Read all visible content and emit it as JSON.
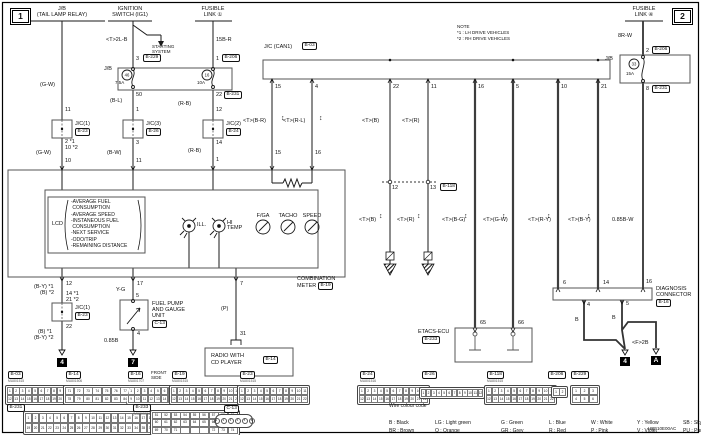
{
  "page": {
    "no_left": "1",
    "no_right": "2",
    "corner_code": "HBF10E00AC"
  },
  "icons": {
    "twist": "↕"
  },
  "note": {
    "title": "NOTE",
    "l1": "*1 : LH DRIVE VEHICLES",
    "l2": "*2 : RH DRIVE VEHICLES"
  },
  "top": {
    "jb1": "J/B",
    "jb2": "(TAIL LAMP RELAY)",
    "ign1": "IGNITION",
    "ign2": "SWITCH (IG1)",
    "fl1a": "FUSIBLE",
    "fl1b": "LINK ①",
    "fl4a": "FUSIBLE",
    "fl4b": "LINK ④",
    "ss1": "STARTING",
    "ss2": "SYSTEM"
  },
  "jb": {
    "left": "J/B",
    "right": "J/B",
    "f46": "46",
    "f46a": "7.5A",
    "f16": "16",
    "f16a": "10A",
    "f33": "33",
    "f33a": "15A"
  },
  "comp": {
    "jc_can": "J/C (CAN1)",
    "jc1": "J/C(1)",
    "jc2": "J/C(2)",
    "jc3": "J/C(3)",
    "jc1l": "J/C(1)",
    "fuel1": "FUEL PUMP",
    "fuel2": "AND GAUGE",
    "fuel3": "UNIT",
    "radio1": "RADIO WITH",
    "radio2": "CD PLAYER",
    "etacs": "ETACS-ECU",
    "diag1": "DIAGNOSIS",
    "diag2": "CONNECTOR"
  },
  "refs": {
    "b229": "B-229",
    "b206a": "B-206",
    "b206b": "B-206",
    "b231a": "B-231",
    "b231b": "B-231",
    "b23a": "B-23",
    "b26": "B-26",
    "b24": "B-24",
    "b03": "B-03",
    "b118": "B-118",
    "b19": "B-19",
    "b23b": "B-23",
    "c13": "C-13",
    "b14": "B-14",
    "b233": "B-233",
    "b16": "B-16"
  },
  "wires": {
    "gw1": "(G-W)",
    "t2lb": "<T>2L-B",
    "f15br": "15B-R",
    "f8rw": "8R-W",
    "bl": "(B-L)",
    "rb1": "(R-B)",
    "rb2": "(R-B)",
    "gw2": "(G-W)",
    "bw": "(B-W)",
    "cbr": "<T>(B-R)",
    "crl": "<T>(R-L)",
    "cb1": "<T>(B)",
    "cr1": "<T>(R)",
    "cb2": "<T>(B)",
    "cr2": "<T>(R)",
    "cbg": "<T>(B-G)",
    "cgw": "<T>(G-W)",
    "cry": "<T>(R-Y)",
    "cby": "<T>(B-Y)",
    "w085bw": "0.85B-W",
    "by1": "(B-Y) *1",
    "b2": "(B) *2",
    "b1": "(B) *1",
    "by2": "(B-Y) *2",
    "yg": "Y-G",
    "w085b": "0.85B",
    "p": "(P)",
    "bd1": "B",
    "bd2": "B",
    "f2b": "<F>2B"
  },
  "pins": {
    "p3": "3",
    "p1a": "1",
    "p50": "50",
    "p22a": "22",
    "p2": "2",
    "p8": "8",
    "p11a": "11",
    "p1b": "1",
    "p12a": "12",
    "p2s": "2 *1",
    "p10s": "10 *2",
    "p3b": "3",
    "p14s": "14 *1",
    "p21s": "21 *2",
    "p14a": "14",
    "p10": "10",
    "p11b": "11",
    "p1c": "1",
    "c15": "15",
    "c4": "4",
    "c22": "22",
    "c11": "11",
    "c16": "16",
    "c5": "5",
    "c10": "10",
    "c21": "21",
    "m15": "15",
    "m16": "16",
    "b118_12": "12",
    "b118_13": "13",
    "m12": "12",
    "m17": "17",
    "m7": "7",
    "p22b": "22",
    "p5": "5",
    "p4": "4",
    "p31": "31",
    "e65": "65",
    "e66": "66",
    "d6": "6",
    "d14": "14",
    "d16": "16",
    "d4": "4",
    "d5": "5"
  },
  "grounds": {
    "g4a": "4",
    "g7": "7",
    "g4b": "4",
    "ga": "A"
  },
  "meter": {
    "lcd": "LCD",
    "lines": [
      "-AVERAGE FUEL",
      " CONSUMPTION",
      "-AVERAGE SPEED",
      "-INSTANEOUS FUEL",
      " CONSUMPTION",
      "-NEXT SERVICE",
      "-ODO/TRIP",
      "-REMAINING DISTANCE"
    ],
    "ill": "ILL.",
    "hi1": "HI",
    "hi2": "TEMP",
    "g1": "F/GA",
    "g2": "TACHO",
    "g3": "SPEED",
    "n1": "COMBINATION",
    "n2": "METER"
  },
  "tables": {
    "b03": {
      "t": "B-03",
      "c": "MU801515",
      "r": [
        [
          1,
          2,
          3,
          4,
          5,
          6,
          7,
          8,
          9,
          10,
          11
        ],
        [
          12,
          13,
          14,
          15,
          16,
          17,
          18,
          19,
          20,
          21,
          22
        ]
      ]
    },
    "b14": {
      "t": "B-14",
      "c": "MU801506",
      "r": [
        [
          71,
          72,
          73,
          74,
          75,
          76,
          77
        ],
        [
          78,
          79,
          80,
          81,
          82,
          83,
          84
        ]
      ]
    },
    "b16": {
      "t": "B-16",
      "c": "MU801707",
      "n1": "FRONT",
      "n2": "SIDE",
      "r": [
        [
          1,
          2,
          3,
          4,
          5,
          6,
          7,
          8
        ],
        [
          9,
          10,
          11,
          12,
          13,
          14,
          15,
          16
        ]
      ]
    },
    "b19": {
      "t": "B-19",
      "c": "MU801515",
      "r": [
        [
          1,
          2,
          3,
          4,
          5,
          6,
          7,
          8,
          9,
          10,
          11
        ],
        [
          12,
          13,
          14,
          15,
          16,
          17,
          18,
          19,
          20,
          21,
          22
        ]
      ]
    },
    "b23": {
      "t": "B-23",
      "c": "MU801515",
      "r": [
        [
          1,
          2,
          3,
          4,
          5,
          6,
          7,
          8,
          9,
          10,
          11
        ],
        [
          12,
          13,
          14,
          15,
          16,
          17,
          18,
          19,
          20,
          21,
          22
        ]
      ]
    },
    "b24": {
      "t": "B-24",
      "c": "MU801516",
      "r": [
        [
          1,
          2,
          3,
          4,
          5,
          6,
          7,
          8,
          9,
          10,
          11
        ],
        [
          12,
          13,
          14,
          15,
          16,
          17,
          18,
          19,
          20,
          21,
          22
        ]
      ]
    },
    "b26": {
      "t": "B-26",
      "r": [
        [
          1,
          2,
          3,
          4,
          5,
          6,
          7,
          8,
          9,
          10,
          11,
          12
        ]
      ]
    },
    "b118": {
      "t": "B-118",
      "c": "MU801515",
      "r": [
        [
          1,
          2,
          3,
          4,
          5,
          6,
          7,
          8,
          9,
          10,
          11
        ],
        [
          12,
          13,
          14,
          15,
          16,
          17,
          18,
          19,
          20,
          21,
          22
        ]
      ]
    },
    "b206": {
      "t": "B-206",
      "r": [
        [
          1,
          2
        ]
      ]
    },
    "b229": {
      "t": "B-229",
      "r": [
        [
          1,
          2,
          3
        ],
        [
          4,
          5,
          6
        ]
      ]
    },
    "b231": {
      "t": "B-231",
      "r": [
        [
          1,
          2,
          3,
          4,
          5,
          6,
          7,
          8,
          9,
          10,
          11,
          12,
          13,
          14,
          15,
          16,
          17,
          18
        ],
        [
          19,
          20,
          21,
          22,
          23,
          24,
          25,
          26,
          27,
          28,
          29,
          30,
          31,
          32,
          33,
          34,
          35,
          36
        ]
      ]
    },
    "b233": {
      "t": "B-233",
      "c": "(MU803746)",
      "r": [
        [
          51,
          52,
          53,
          54,
          55,
          56,
          57,
          58,
          59
        ],
        [
          60,
          61,
          62,
          63,
          64,
          65,
          66,
          67,
          68
        ],
        [
          "69",
          "70",
          "71",
          "",
          "",
          "",
          "72",
          "73",
          "74"
        ]
      ]
    },
    "c13": {
      "t": "C-13",
      "pins": [
        "1",
        "2",
        "3",
        "4",
        "5",
        "6"
      ]
    }
  },
  "legend": {
    "title": "Wire colour code",
    "row1": [
      "B : Black",
      "LG : Light green",
      "G : Green",
      "L : Blue",
      "W : White",
      "Y : Yellow",
      "SB : Sky blue"
    ],
    "row2": [
      "BR : Brown",
      "O : Orange",
      "GR : Grey",
      "R : Red",
      "P : Pink",
      "V : Violet",
      "PU : Purple",
      "SI : Silver"
    ]
  }
}
